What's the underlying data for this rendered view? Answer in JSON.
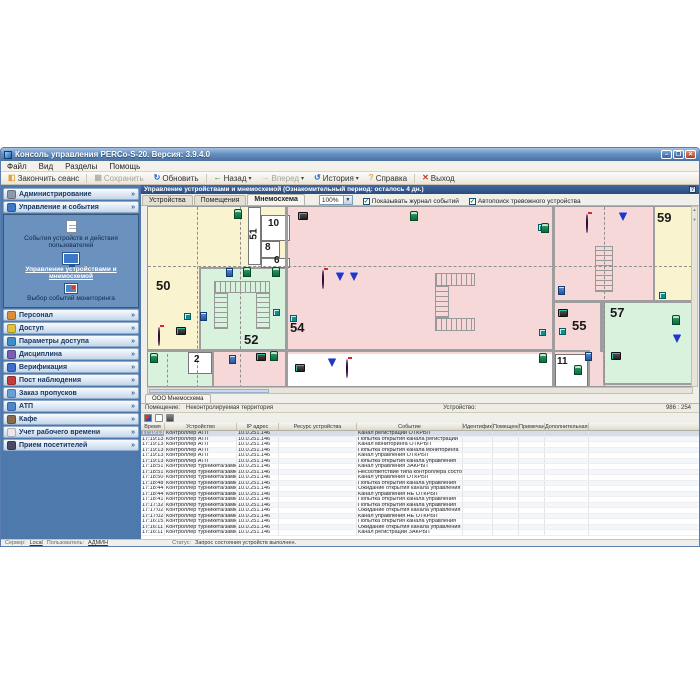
{
  "window": {
    "title": "Консоль управления PERCo-S-20. Версия: 3.9.4.0",
    "menu": [
      "Файл",
      "Вид",
      "Разделы",
      "Помощь"
    ],
    "controls": {
      "minimize": "–",
      "maximize": "❐",
      "close": "✕"
    },
    "toolbar": [
      {
        "label": "Закончить сеанс",
        "icon": "session-end-icon",
        "glyph": "◧",
        "color": "#e0a23c",
        "enabled": true,
        "dropdown": false
      },
      {
        "label": "Сохранить",
        "icon": "save-icon",
        "glyph": "▦",
        "color": "#9aa0a8",
        "enabled": false,
        "dropdown": false
      },
      {
        "label": "Обновить",
        "icon": "refresh-icon",
        "glyph": "↻",
        "color": "#2464c4",
        "enabled": true,
        "dropdown": false
      },
      {
        "label": "Назад",
        "icon": "back-icon",
        "glyph": "←",
        "color": "#2e7d32",
        "enabled": true,
        "dropdown": true
      },
      {
        "label": "Вперед",
        "icon": "forward-icon",
        "glyph": "→",
        "color": "#9aa0a8",
        "enabled": false,
        "dropdown": true
      },
      {
        "label": "История",
        "icon": "history-icon",
        "glyph": "↺",
        "color": "#2464c4",
        "enabled": true,
        "dropdown": true
      },
      {
        "label": "Справка",
        "icon": "help-icon",
        "glyph": "?",
        "color": "#e0a23c",
        "enabled": true,
        "dropdown": false
      },
      {
        "label": "Выход",
        "icon": "exit-icon",
        "glyph": "✕",
        "color": "#c33c1c",
        "enabled": true,
        "dropdown": false
      }
    ]
  },
  "sidebar": {
    "sections": [
      {
        "label": "Администрирование",
        "icon": "gear-icon",
        "color": "#8d99a8",
        "expanded": false
      },
      {
        "label": "Управление и события",
        "icon": "monitor-icon",
        "color": "#3a78c8",
        "expanded": true,
        "items": [
          {
            "label": "События устройств и действия пользователей",
            "icon": "events-log-icon",
            "active": false
          },
          {
            "label": "Управление устройствами и мнемосхемой",
            "icon": "mnemoscheme-icon",
            "active": true
          },
          {
            "label": "Выбор событий мониторинга",
            "icon": "monitor-select-icon",
            "active": false
          }
        ]
      },
      {
        "label": "Персонал",
        "icon": "person-icon",
        "color": "#d88f3a",
        "expanded": false
      },
      {
        "label": "Доступ",
        "icon": "key-icon",
        "color": "#e0c23c",
        "expanded": false
      },
      {
        "label": "Параметры доступа",
        "icon": "globe-key-icon",
        "color": "#3f8cc9",
        "expanded": false
      },
      {
        "label": "Дисциплина",
        "icon": "discipline-icon",
        "color": "#7a5fb0",
        "expanded": false
      },
      {
        "label": "Верификация",
        "icon": "verification-icon",
        "color": "#3a6ecc",
        "expanded": false
      },
      {
        "label": "Пост наблюдения",
        "icon": "camera-post-icon",
        "color": "#c23c3c",
        "expanded": false
      },
      {
        "label": "Заказ пропусков",
        "icon": "pass-card-icon",
        "color": "#6aa0d8",
        "expanded": false
      },
      {
        "label": "АТП",
        "icon": "vehicle-icon",
        "color": "#4d86c8",
        "expanded": false
      },
      {
        "label": "Кафе",
        "icon": "cafe-icon",
        "color": "#8a6a4a",
        "expanded": false
      },
      {
        "label": "Учет рабочего времени",
        "icon": "clock-icon",
        "color": "#e8e8ee",
        "expanded": false
      },
      {
        "label": "Прием посетителей",
        "icon": "visitors-icon",
        "color": "#4a4a66",
        "expanded": false
      }
    ]
  },
  "panel": {
    "title": "Управление устройствами и мнемосхемой (Ознакомительный период: осталось 4 дн.)",
    "tabs": [
      "Устройства",
      "Помещения",
      "Мнемосхема"
    ],
    "active_tab": "Мнемосхема",
    "zoom_value": "100%",
    "checkboxes": [
      {
        "label": "Показывать журнал событий",
        "checked": true
      },
      {
        "label": "Автопоиск тревожного устройства",
        "checked": true
      }
    ]
  },
  "map": {
    "scheme_tab": "ООО Мнемосхема",
    "info": {
      "room_label": "Помещение:",
      "room_value": "Неконтролируемая территория",
      "device_label": "Устройство:",
      "device_value": "",
      "coords": "986 : 254"
    },
    "rooms": [
      {
        "c": "yellow",
        "x": 0,
        "y": 0,
        "w": 137,
        "h": 142,
        "style": ""
      },
      {
        "c": "green",
        "x": 51,
        "y": 60,
        "w": 88,
        "h": 84,
        "style": "outlined"
      },
      {
        "c": "white",
        "x": 100,
        "y": 0,
        "w": 13,
        "h": 58,
        "style": "thin"
      },
      {
        "c": "white",
        "x": 113,
        "y": 8,
        "w": 29,
        "h": 26,
        "style": "thin"
      },
      {
        "c": "white",
        "x": 113,
        "y": 34,
        "w": 19,
        "h": 17,
        "style": "thin"
      },
      {
        "c": "white",
        "x": 113,
        "y": 51,
        "w": 29,
        "h": 10,
        "style": "thin"
      },
      {
        "c": "yellow",
        "x": 505,
        "y": 0,
        "w": 44,
        "h": 94,
        "style": ""
      },
      {
        "c": "green",
        "x": 455,
        "y": 94,
        "w": 94,
        "h": 84,
        "style": "outlined"
      },
      {
        "c": "white",
        "x": 137,
        "y": 147,
        "w": 267,
        "h": 34,
        "style": ""
      },
      {
        "c": "green",
        "x": 0,
        "y": 145,
        "w": 64,
        "h": 36,
        "style": ""
      },
      {
        "c": "pink",
        "x": 66,
        "y": 145,
        "w": 71,
        "h": 36,
        "style": ""
      },
      {
        "c": "white",
        "x": 40,
        "y": 145,
        "w": 24,
        "h": 22,
        "style": "thin"
      },
      {
        "c": "white",
        "x": 407,
        "y": 147,
        "w": 33,
        "h": 34,
        "style": "thin"
      }
    ],
    "labels": [
      {
        "text": "50",
        "x": 8,
        "y": 72,
        "small": false,
        "rot": false
      },
      {
        "text": "52",
        "x": 96,
        "y": 126,
        "small": false,
        "rot": false
      },
      {
        "text": "54",
        "x": 142,
        "y": 114,
        "small": false,
        "rot": false
      },
      {
        "text": "55",
        "x": 424,
        "y": 112,
        "small": false,
        "rot": false
      },
      {
        "text": "57",
        "x": 462,
        "y": 99,
        "small": false,
        "rot": false
      },
      {
        "text": "59",
        "x": 509,
        "y": 4,
        "small": false,
        "rot": false
      },
      {
        "text": "51",
        "x": 101,
        "y": 22,
        "small": true,
        "rot": true
      },
      {
        "text": "10",
        "x": 120,
        "y": 12,
        "small": true,
        "rot": false
      },
      {
        "text": "8",
        "x": 117,
        "y": 36,
        "small": true,
        "rot": false
      },
      {
        "text": "6",
        "x": 126,
        "y": 49,
        "small": true,
        "rot": false
      },
      {
        "text": "2",
        "x": 46,
        "y": 148,
        "small": true,
        "rot": false
      },
      {
        "text": "11",
        "x": 409,
        "y": 150,
        "small": true,
        "rot": false
      }
    ],
    "walls": [
      {
        "x": 137,
        "y": 0,
        "w": 3,
        "h": 181
      },
      {
        "x": 404,
        "y": 0,
        "w": 3,
        "h": 181
      },
      {
        "x": 0,
        "y": 142,
        "w": 407,
        "h": 3
      },
      {
        "x": 404,
        "y": 93,
        "w": 145,
        "h": 3
      },
      {
        "x": 452,
        "y": 93,
        "w": 3,
        "h": 52
      },
      {
        "x": 404,
        "y": 143,
        "w": 38,
        "h": 2
      },
      {
        "x": 440,
        "y": 145,
        "w": 2,
        "h": 36
      },
      {
        "x": 505,
        "y": 0,
        "w": 2,
        "h": 94
      },
      {
        "x": 64,
        "y": 145,
        "w": 2,
        "h": 36
      }
    ],
    "dashes": [
      {
        "dir": "v",
        "x": 49,
        "y": 0,
        "len": 181
      },
      {
        "dir": "v",
        "x": 92,
        "y": 0,
        "len": 142
      },
      {
        "dir": "v",
        "x": 92,
        "y": 147,
        "len": 34
      },
      {
        "dir": "v",
        "x": 19,
        "y": 147,
        "len": 34
      },
      {
        "dir": "v",
        "x": 456,
        "y": 0,
        "len": 181
      },
      {
        "dir": "h",
        "x": 0,
        "y": 59,
        "len": 549
      }
    ],
    "stairs": [
      {
        "kind": "u-down",
        "x": 66,
        "y": 74,
        "w": 56,
        "h": 48
      },
      {
        "kind": "u-right",
        "x": 287,
        "y": 66,
        "w": 40,
        "h": 58
      },
      {
        "kind": "straight",
        "x": 447,
        "y": 39,
        "w": 18,
        "h": 46
      }
    ],
    "icons": [
      {
        "type": "turnstile",
        "x": 86,
        "y": 2
      },
      {
        "type": "device",
        "x": 150,
        "y": 5
      },
      {
        "type": "turnstile",
        "x": 262,
        "y": 4
      },
      {
        "type": "door",
        "x": 390,
        "y": 17
      },
      {
        "type": "turnstile",
        "x": 393,
        "y": 16
      },
      {
        "type": "dome",
        "x": 438,
        "y": 8
      },
      {
        "type": "camera",
        "x": 471,
        "y": 6
      },
      {
        "type": "dome",
        "x": 172,
        "y": 64
      },
      {
        "type": "camera",
        "x": 188,
        "y": 66
      },
      {
        "type": "camera",
        "x": 202,
        "y": 66
      },
      {
        "type": "reader",
        "x": 78,
        "y": 61
      },
      {
        "type": "turnstile",
        "x": 95,
        "y": 60
      },
      {
        "type": "turnstile",
        "x": 124,
        "y": 60
      },
      {
        "type": "door",
        "x": 36,
        "y": 106
      },
      {
        "type": "reader",
        "x": 52,
        "y": 105
      },
      {
        "type": "door",
        "x": 125,
        "y": 102
      },
      {
        "type": "door",
        "x": 142,
        "y": 108
      },
      {
        "type": "dome",
        "x": 6,
        "y": 121
      },
      {
        "type": "device",
        "x": 28,
        "y": 120
      },
      {
        "type": "reader",
        "x": 410,
        "y": 79
      },
      {
        "type": "device",
        "x": 410,
        "y": 102
      },
      {
        "type": "door",
        "x": 391,
        "y": 122
      },
      {
        "type": "door",
        "x": 411,
        "y": 121
      },
      {
        "type": "turnstile",
        "x": 391,
        "y": 146
      },
      {
        "type": "turnstile",
        "x": 426,
        "y": 158
      },
      {
        "type": "reader",
        "x": 437,
        "y": 145
      },
      {
        "type": "device",
        "x": 463,
        "y": 145
      },
      {
        "type": "turnstile",
        "x": 524,
        "y": 108
      },
      {
        "type": "camera",
        "x": 525,
        "y": 128
      },
      {
        "type": "door",
        "x": 511,
        "y": 85
      },
      {
        "type": "turnstile",
        "x": 2,
        "y": 146
      },
      {
        "type": "reader",
        "x": 81,
        "y": 148
      },
      {
        "type": "device",
        "x": 108,
        "y": 146
      },
      {
        "type": "turnstile",
        "x": 122,
        "y": 144
      },
      {
        "type": "device",
        "x": 147,
        "y": 157
      },
      {
        "type": "camera",
        "x": 180,
        "y": 152
      },
      {
        "type": "dome",
        "x": 192,
        "y": 153
      }
    ]
  },
  "log": {
    "columns": [
      "Время",
      "Устройство",
      "IP адрес",
      "Ресурс устройства",
      "Событие",
      "Идентификатор",
      "Помещение",
      "Примечание",
      "Дополнительная информация"
    ],
    "col_widths": [
      24,
      72,
      42,
      78,
      106,
      30,
      26,
      26,
      44
    ],
    "rows": [
      [
        "17:19:13",
        "Контроллер АТП",
        "10.0.251.146",
        "",
        "Канал регистрации ОТКРЫТ",
        "",
        "",
        "",
        ""
      ],
      [
        "17:19:13",
        "Контроллер АТП",
        "10.0.251.146",
        "",
        "Попытка открытия канала регистрации",
        "",
        "",
        "",
        ""
      ],
      [
        "17:19:13",
        "Контроллер АТП",
        "10.0.251.146",
        "",
        "Канал мониторинга ОТКРЫТ",
        "",
        "",
        "",
        ""
      ],
      [
        "17:19:13",
        "Контроллер АТП",
        "10.0.251.146",
        "",
        "Попытка открытия канала мониторинга",
        "",
        "",
        "",
        ""
      ],
      [
        "17:19:13",
        "Контроллер АТП",
        "10.0.251.146",
        "",
        "Канал управления ОТКРЫТ",
        "",
        "",
        "",
        ""
      ],
      [
        "17:19:13",
        "Контроллер АТП",
        "10.0.251.146",
        "",
        "Попытка открытия канала управления",
        "",
        "",
        "",
        ""
      ],
      [
        "17:18:51",
        "Контроллер турникета/замка",
        "10.0.251.146",
        "",
        "Канал управления ЗАКРЫТ",
        "",
        "",
        "",
        ""
      ],
      [
        "17:18:51",
        "Контроллер турникета/замка",
        "10.0.251.146",
        "",
        "Несоответствие типа контроллера состоянию",
        "",
        "",
        "",
        ""
      ],
      [
        "17:18:50",
        "Контроллер турникета/замка",
        "10.0.251.146",
        "",
        "Канал управления ОТКРЫТ",
        "",
        "",
        "",
        ""
      ],
      [
        "17:18:48",
        "Контроллер турникета/замка",
        "10.0.251.146",
        "",
        "Попытка открытия канала управления",
        "",
        "",
        "",
        ""
      ],
      [
        "17:18:44",
        "Контроллер турникета/замка",
        "10.0.251.146",
        "",
        "Ожидание открытия канала управления",
        "",
        "",
        "",
        ""
      ],
      [
        "17:18:44",
        "Контроллер турникета/замка",
        "10.0.251.146",
        "",
        "Канал управления НЕ ОТКРЫТ",
        "",
        "",
        "",
        ""
      ],
      [
        "17:18:41",
        "Контроллер турникета/замка",
        "10.0.251.146",
        "",
        "Попытка открытия канала управления",
        "",
        "",
        "",
        ""
      ],
      [
        "17:17:32",
        "Контроллер турникета/замка",
        "10.0.251.146",
        "",
        "Попытка открытия канала управления",
        "",
        "",
        "",
        ""
      ],
      [
        "17:17:02",
        "Контроллер турникета/замка",
        "10.0.251.146",
        "",
        "Ожидание открытия канала управления",
        "",
        "",
        "",
        ""
      ],
      [
        "17:17:02",
        "Контроллер турникета/замка",
        "10.0.251.146",
        "",
        "Канал управления НЕ ОТКРЫТ",
        "",
        "",
        "",
        ""
      ],
      [
        "17:16:15",
        "Контроллер турникета/замка",
        "10.0.251.146",
        "",
        "Попытка открытия канала управления",
        "",
        "",
        "",
        ""
      ],
      [
        "17:16:11",
        "Контроллер турникета/замка",
        "10.0.251.146",
        "",
        "Ожидание открытия канала управления",
        "",
        "",
        "",
        ""
      ],
      [
        "17:16:11",
        "Контроллер турникета/замка",
        "10.0.251.146",
        "",
        "Канал регистрации ЗАКРЫТ",
        "",
        "",
        "",
        ""
      ]
    ],
    "selected_row": 0
  },
  "statusbar": {
    "server_label": "Сервер:",
    "server_value": "Local",
    "user_label": "Пользователь:",
    "user_value": "АДМИН",
    "status_label": "Статус:",
    "status_value": "Запрос состояния устройств выполнен."
  },
  "colors": {
    "titlebar": "#6690c2",
    "sidebar": "#4e79ad",
    "panel_header": "#2a4d80",
    "room_pink": "#f6d8d8",
    "room_yellow": "#faf3cf",
    "room_green": "#d9f2de",
    "wall": "#9e9e9e",
    "selection": "#d7dde8"
  }
}
